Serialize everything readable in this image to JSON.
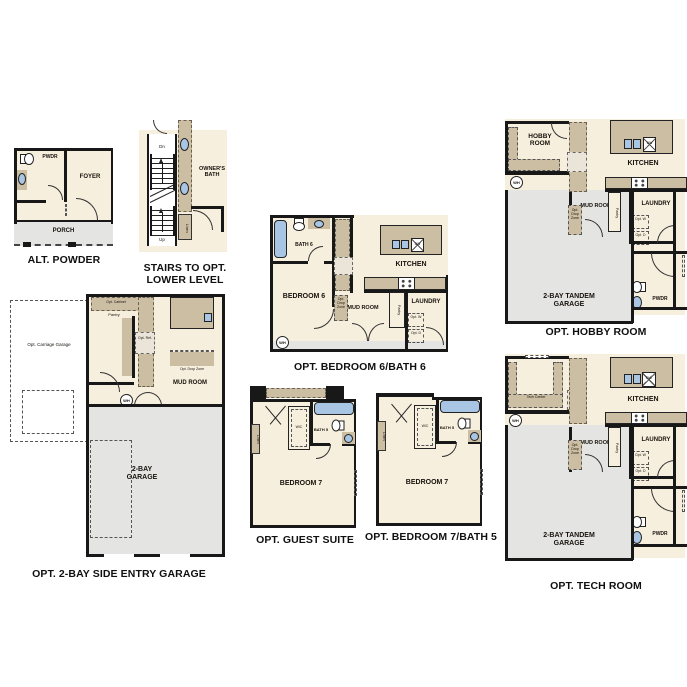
{
  "colors": {
    "floor": "#F7EFDE",
    "counter": "#CBBEA2",
    "garage_gray": "#E4E4E2",
    "wall": "#181818",
    "fixture_blue": "#A8C5E3"
  },
  "shared": {
    "kitchen": "KITCHEN",
    "mud_room": "MUD ROOM",
    "laundry": "LAUNDRY",
    "pwdr": "PWDR",
    "pantry": "Pantry",
    "linen": "Linen",
    "wic": "WIC",
    "wh": "WH",
    "dw": "DW",
    "opt_w": "Opt. W",
    "opt_d": "Opt. D",
    "opt_drop_zone": "Opt. Drop Zone",
    "bedroom7": "BEDROOM 7",
    "bath5": "BATH 5",
    "tandem_garage": "2-BAY TANDEM GARAGE"
  },
  "plans": {
    "alt_powder": {
      "caption": "ALT. POWDER",
      "foyer": "FOYER",
      "porch": "PORCH"
    },
    "stairs": {
      "caption": "STAIRS TO OPT. LOWER LEVEL",
      "dn": "Dn",
      "up": "Up",
      "owners_bath": "OWNER'S BATH"
    },
    "bedroom6": {
      "caption": "OPT. BEDROOM 6/BATH 6",
      "bedroom": "BEDROOM 6",
      "bath": "BATH 6"
    },
    "hobby": {
      "caption": "OPT. HOBBY ROOM",
      "hobby_room": "HOBBY ROOM"
    },
    "side_garage": {
      "caption": "OPT. 2-BAY SIDE ENTRY GARAGE",
      "garage": "2-BAY GARAGE",
      "opt_cabinet": "Opt. Cabinet",
      "opt_carriage_garage": "Opt. Carriage Garage",
      "opt_ref": "Opt. Ref."
    },
    "guest_suite": {
      "caption": "OPT. GUEST SUITE"
    },
    "bedroom7_bath5": {
      "caption": "OPT. BEDROOM 7/BATH 5"
    },
    "tech": {
      "caption": "OPT. TECH ROOM",
      "tech_center": "Tech Center",
      "opt_ref": "Opt. Ref"
    }
  }
}
